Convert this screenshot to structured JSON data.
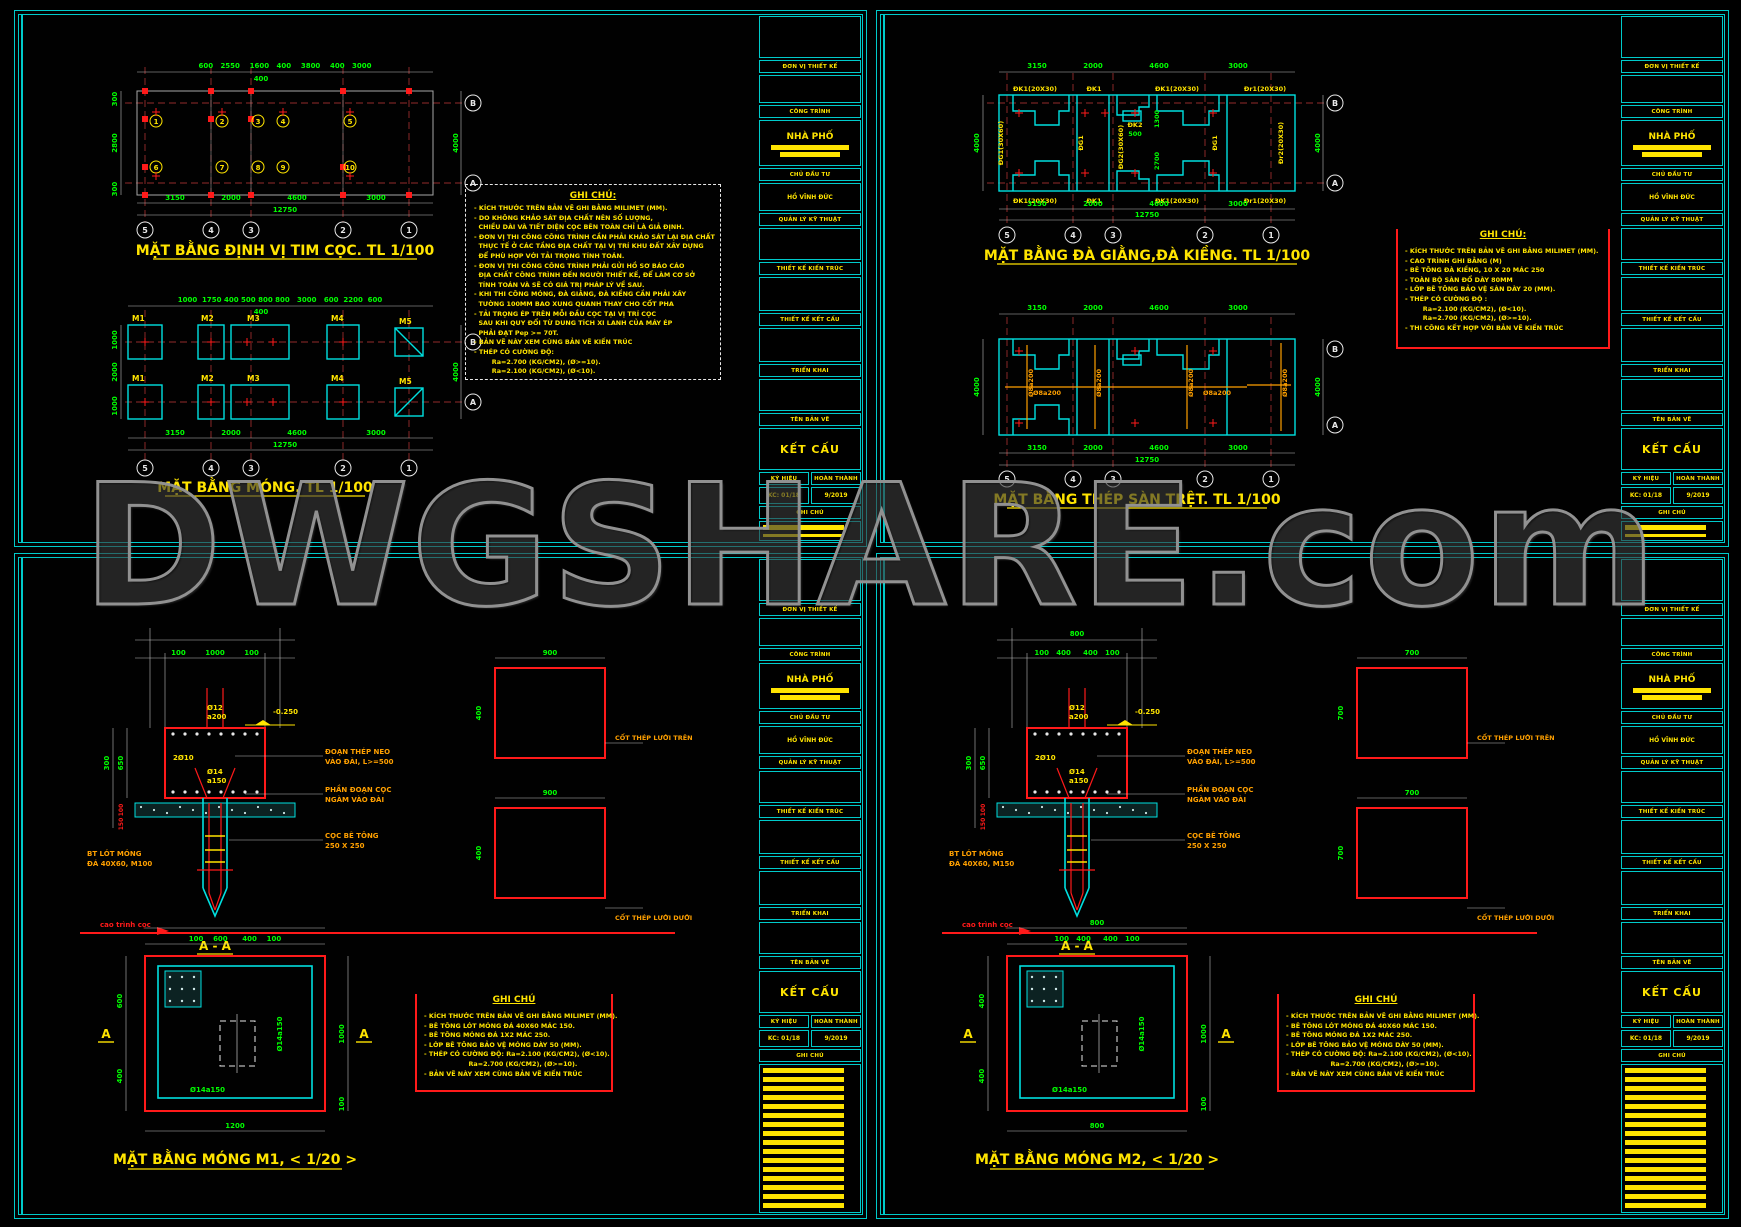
{
  "watermark": "DWGSHARE.com",
  "colors": {
    "cyan": "#00e0e0",
    "red": "#ff1a1a",
    "green": "#00ff00",
    "yellow": "#ffe400",
    "orange": "#ffa000",
    "white": "#e8e8e8"
  },
  "titleblock": {
    "top_label": "ĐƠN VỊ THIẾT KẾ",
    "rows": [
      {
        "h": "CÔNG TRÌNH",
        "v": "NHÀ PHỐ",
        "redact": true
      },
      {
        "h": "CHỦ ĐẦU TƯ",
        "v": "HỒ VĨNH ĐỨC"
      },
      {
        "h": "QUẢN LÝ KỸ THUẬT",
        "v": ""
      },
      {
        "h": "THIẾT KẾ KIẾN TRÚC",
        "v": ""
      },
      {
        "h": "THIẾT KẾ KẾT CẤU",
        "v": ""
      },
      {
        "h": "TRIỂN KHAI",
        "v": ""
      },
      {
        "h": "TÊN BẢN VẼ",
        "v": "KẾT CẤU",
        "big": true
      }
    ],
    "sign_label": "KÝ HIỆU",
    "date_label": "HOÀN THÀNH",
    "sign_value": "KC: 01/18",
    "date_value": "9/2019",
    "note_label": "GHI CHÚ"
  },
  "q1": {
    "plan1": {
      "title": "MẶT BẰNG ĐỊNH VỊ TIM CỌC. TL 1/100",
      "dims_top": "600   2550    1600   400    3800    400   3000",
      "dim_top2": "400",
      "d_b1": "3150",
      "d_b2": "2000",
      "d_b3": "4600",
      "d_b4": "3000",
      "d_total": "12750",
      "d_l1": "300",
      "d_l2": "2800",
      "d_l3": "300",
      "d_r": "4000",
      "piles_top": [
        "1",
        "2",
        "3",
        "4",
        "5"
      ],
      "piles_bot": [
        "6",
        "7",
        "8",
        "9",
        "10"
      ],
      "cols": [
        "5",
        "4",
        "3",
        "2",
        "1"
      ],
      "row_b": "B",
      "row_a": "A"
    },
    "plan2": {
      "title": "MẶT BẰNG MÓNG. TL 1/100",
      "dims_top": "1000  1750 400 500 800 800   3000   600  2200  600",
      "dim_top2": "400",
      "d_b1": "3150",
      "d_b2": "2000",
      "d_b3": "4600",
      "d_b4": "3000",
      "d_total": "12750",
      "d_l1": "1000",
      "d_l2": "2000",
      "d_l3": "1000",
      "d_r": "4000",
      "footings": [
        "M1",
        "M2",
        "M3",
        "M4",
        "M5"
      ],
      "cols": [
        "5",
        "4",
        "3",
        "2",
        "1"
      ],
      "row_b": "B",
      "row_a": "A"
    },
    "notes": {
      "title": "GHI CHÚ:",
      "lines": [
        "- KÍCH THƯỚC TRÊN BẢN VẼ GHI BẰNG MILIMET (MM).",
        "- DO KHÔNG KHẢO SÁT ĐỊA CHẤT NÊN SỐ LƯỢNG,",
        "  CHIỀU DÀI VÀ TIẾT DIỆN CỌC BÊN TOÀN CHỈ LÀ GIẢ ĐỊNH.",
        "- ĐƠN VỊ THI CÔNG CÔNG TRÌNH CẦN PHẢI KHẢO SÁT LẠI ĐỊA CHẤT",
        "  THỰC TẾ Ở CÁC TẦNG ĐỊA CHẤT TẠI VỊ TRÍ KHU ĐẤT XÂY DỰNG",
        "  ĐỂ PHÙ HỢP VỚI TẢI TRỌNG TÍNH TOÁN.",
        "- ĐƠN VỊ THI CÔNG CÔNG TRÌNH PHẢI GỬI HỒ SƠ BÁO CÁO",
        "  ĐỊA CHẤT CÔNG TRÌNH ĐẾN NGƯỜI THIẾT KẾ, ĐỂ LÀM CƠ SỞ",
        "  TÍNH TOÁN VÀ SẼ CÓ GIÁ TRỊ PHÁP LÝ VỀ SAU.",
        "- KHI THI CÔNG MÓNG, ĐÀ GIẰNG, ĐÀ KIỀNG CẦN PHẢI XÂY",
        "  TƯỜNG 100MM BAO XUNG QUANH THAY CHO CỐT PHA",
        "- TẢI TRỌNG ÉP TRÊN MỖI ĐẦU CỌC TẠI VỊ TRÍ CỌC",
        "  SAU KHI QUY ĐỔI TỪ DUNG TÍCH XI LANH CỦA MÁY ÉP",
        "  PHẢI ĐẠT Pep >= 70T.",
        "- BẢN VẼ NÀY XEM CÙNG BẢN VẼ KIẾN TRÚC",
        "- THÉP CÓ CƯỜNG ĐỘ:",
        "        Ra=2.700 (KG/CM2), (Ø>=10).",
        "        Ra=2.100 (KG/CM2), (Ø<10)."
      ]
    }
  },
  "q2": {
    "plan1": {
      "title": "MẶT BẰNG ĐÀ GIẰNG,ĐÀ KIỀNG. TL 1/100",
      "beams_top": [
        "ĐK1(20X30)",
        "ĐK1",
        "ĐK1(20X30)",
        "Đr1(20X30)"
      ],
      "beams_bot": [
        "ĐK1(20X30)",
        "ĐK1",
        "ĐK1(20X30)",
        "Đr1(20X30)"
      ],
      "beams_vert": [
        "ĐG1(30X60)",
        "ĐG1",
        "ĐG2(30X60)",
        "ĐG1",
        "Đr2(20X30)"
      ],
      "beam_mid": "ĐK2",
      "d_500": "500",
      "d_1300": "1300",
      "d_2700": "2700",
      "d_b1": "3150",
      "d_b2": "2000",
      "d_b3": "4600",
      "d_b4": "3000",
      "d_total": "12750",
      "d_l": "4000",
      "d_r": "4000",
      "cols": [
        "5",
        "4",
        "3",
        "2",
        "1"
      ],
      "row_b": "B",
      "row_a": "A"
    },
    "plan2": {
      "title": "MẶT BẰNG THÉP SÀN TRỆT. TL 1/100",
      "bars": [
        "Ø8a200",
        "Ø8a200",
        "Ø8a200",
        "Ø8a200",
        "Ø8a200",
        "Ø8a200"
      ],
      "d_b1": "3150",
      "d_b2": "2000",
      "d_b3": "4600",
      "d_b4": "3000",
      "d_total": "12750",
      "d_l": "4000",
      "d_r": "4000",
      "cols": [
        "5",
        "4",
        "3",
        "2",
        "1"
      ],
      "row_b": "B",
      "row_a": "A"
    },
    "notes": {
      "title": "GHI CHÚ:",
      "lines": [
        "- KÍCH THƯỚC TRÊN BẢN VẼ GHI BẰNG MILIMET (MM).",
        "- CAO TRÌNH GHI BẰNG (M)",
        "- BÊ TÔNG ĐÀ KIỀNG, 10 X 20 MÁC 250",
        "- TOÀN BỘ SÀN ĐỔ DÀY 80MM",
        "- LỚP BÊ TÔNG BẢO VỆ SÀN DÀY 20 (MM).",
        "- THÉP CÓ CƯỜNG ĐỘ :",
        "        Ra=2.100 (KG/CM2), (Ø<10).",
        "        Ra=2.700 (KG/CM2), (Ø>=10).",
        "- THI CÔNG KẾT HỢP VỚI BẢN VẼ KIẾN TRÚC"
      ]
    }
  },
  "q3": {
    "section": {
      "dim_total": "",
      "dims": "100        1000        100",
      "phi12": "Ø12",
      "a200": "a200",
      "level": "-0.250",
      "bars": "2Ø10",
      "phi14": "Ø14",
      "a150": "a150",
      "d300": "300",
      "d650": "650",
      "d100": "100",
      "d150": "150",
      "co1a": "ĐOẠN THÉP NEO",
      "co1b": "VÀO ĐÀI, L>=500",
      "co2a": "PHẦN ĐOẠN CỌC",
      "co2b": "NGÀM VÀO ĐÀI",
      "co3a": "CỌC BÊ TÔNG",
      "co3b": "250 X 250",
      "bt1": "BT LÓT MÓNG",
      "bt2": "ĐÁ 40X60, M100",
      "ground": "cao trình cọc",
      "label": "A - A"
    },
    "mesh": {
      "dim": "900",
      "d2": "400",
      "top": "CỐT THÉP LƯỚI TRÊN",
      "bottom": "CỐT THÉP LƯỚI DƯỚI"
    },
    "plan": {
      "title": "MẶT BẰNG MÓNG M1, < 1/20 >",
      "dim_total": "",
      "dims": "100    600      400    100",
      "bottom": "1200",
      "l1": "600",
      "l2": "400",
      "r1": "1000",
      "r2": "100",
      "rebar1": "Ø14a150",
      "rebar2": "Ø14a150",
      "marker": "A"
    },
    "notes": {
      "title": "GHI CHÚ",
      "lines": [
        "- KÍCH THƯỚC TRÊN BẢN VẼ GHI BẰNG MILIMET (MM).",
        "- BÊ TÔNG LÓT MÓNG ĐÁ 40X60 MÁC 150.",
        "- BÊ TÔNG MÓNG ĐÁ 1X2 MÁC 250.",
        "- LỚP BÊ TÔNG BẢO VỆ MÓNG DÀY 50 (MM).",
        "- THÉP CÓ CƯỜNG ĐỘ: Ra=2.100 (KG/CM2), (Ø<10).",
        "                    Ra=2.700 (KG/CM2), (Ø>=10).",
        "- BẢN VẼ NÀY XEM CÙNG BẢN VẼ KIẾN TRÚC"
      ]
    }
  },
  "q4": {
    "section": {
      "dim_total": "800",
      "dims": "100   400     400   100",
      "phi12": "Ø12",
      "a200": "a200",
      "level": "-0.250",
      "bars": "2Ø10",
      "phi14": "Ø14",
      "a150": "a150",
      "d300": "300",
      "d650": "650",
      "d100": "100",
      "d150": "150",
      "co1a": "ĐOẠN THÉP NEO",
      "co1b": "VÀO ĐÀI, L>=500",
      "co2a": "PHẦN ĐOẠN CỌC",
      "co2b": "NGÀM VÀO ĐÀI",
      "co3a": "CỌC BÊ TÔNG",
      "co3b": "250 X 250",
      "bt1": "BT LÓT MÓNG",
      "bt2": "ĐÁ 40X60, M150",
      "ground": "cao trình cọc",
      "label": "A - A"
    },
    "mesh": {
      "dim": "700",
      "d2": "700",
      "top": "CỐT THÉP LƯỚI TRÊN",
      "bottom": "CỐT THÉP LƯỚI DƯỚI"
    },
    "plan": {
      "title": "MẶT BẰNG MÓNG M2, < 1/20 >",
      "dim_total": "800",
      "dims": "100   400     400   100",
      "bottom": "800",
      "l1": "400",
      "l2": "400",
      "r1": "1000",
      "r2": "100",
      "rebar1": "Ø14a150",
      "rebar2": "Ø14a150",
      "marker": "A"
    },
    "notes": {
      "title": "GHI CHÚ",
      "lines": [
        "- KÍCH THƯỚC TRÊN BẢN VẼ GHI BẰNG MILIMET (MM).",
        "- BÊ TÔNG LÓT MÓNG ĐÁ 40X60 MÁC 150.",
        "- BÊ TÔNG MÓNG ĐÁ 1X2 MÁC 250.",
        "- LỚP BÊ TÔNG BẢO VỆ MÓNG DÀY 50 (MM).",
        "- THÉP CÓ CƯỜNG ĐỘ: Ra=2.100 (KG/CM2), (Ø<10).",
        "                    Ra=2.700 (KG/CM2), (Ø>=10).",
        "- BẢN VẼ NÀY XEM CÙNG BẢN VẼ KIẾN TRÚC"
      ]
    }
  }
}
